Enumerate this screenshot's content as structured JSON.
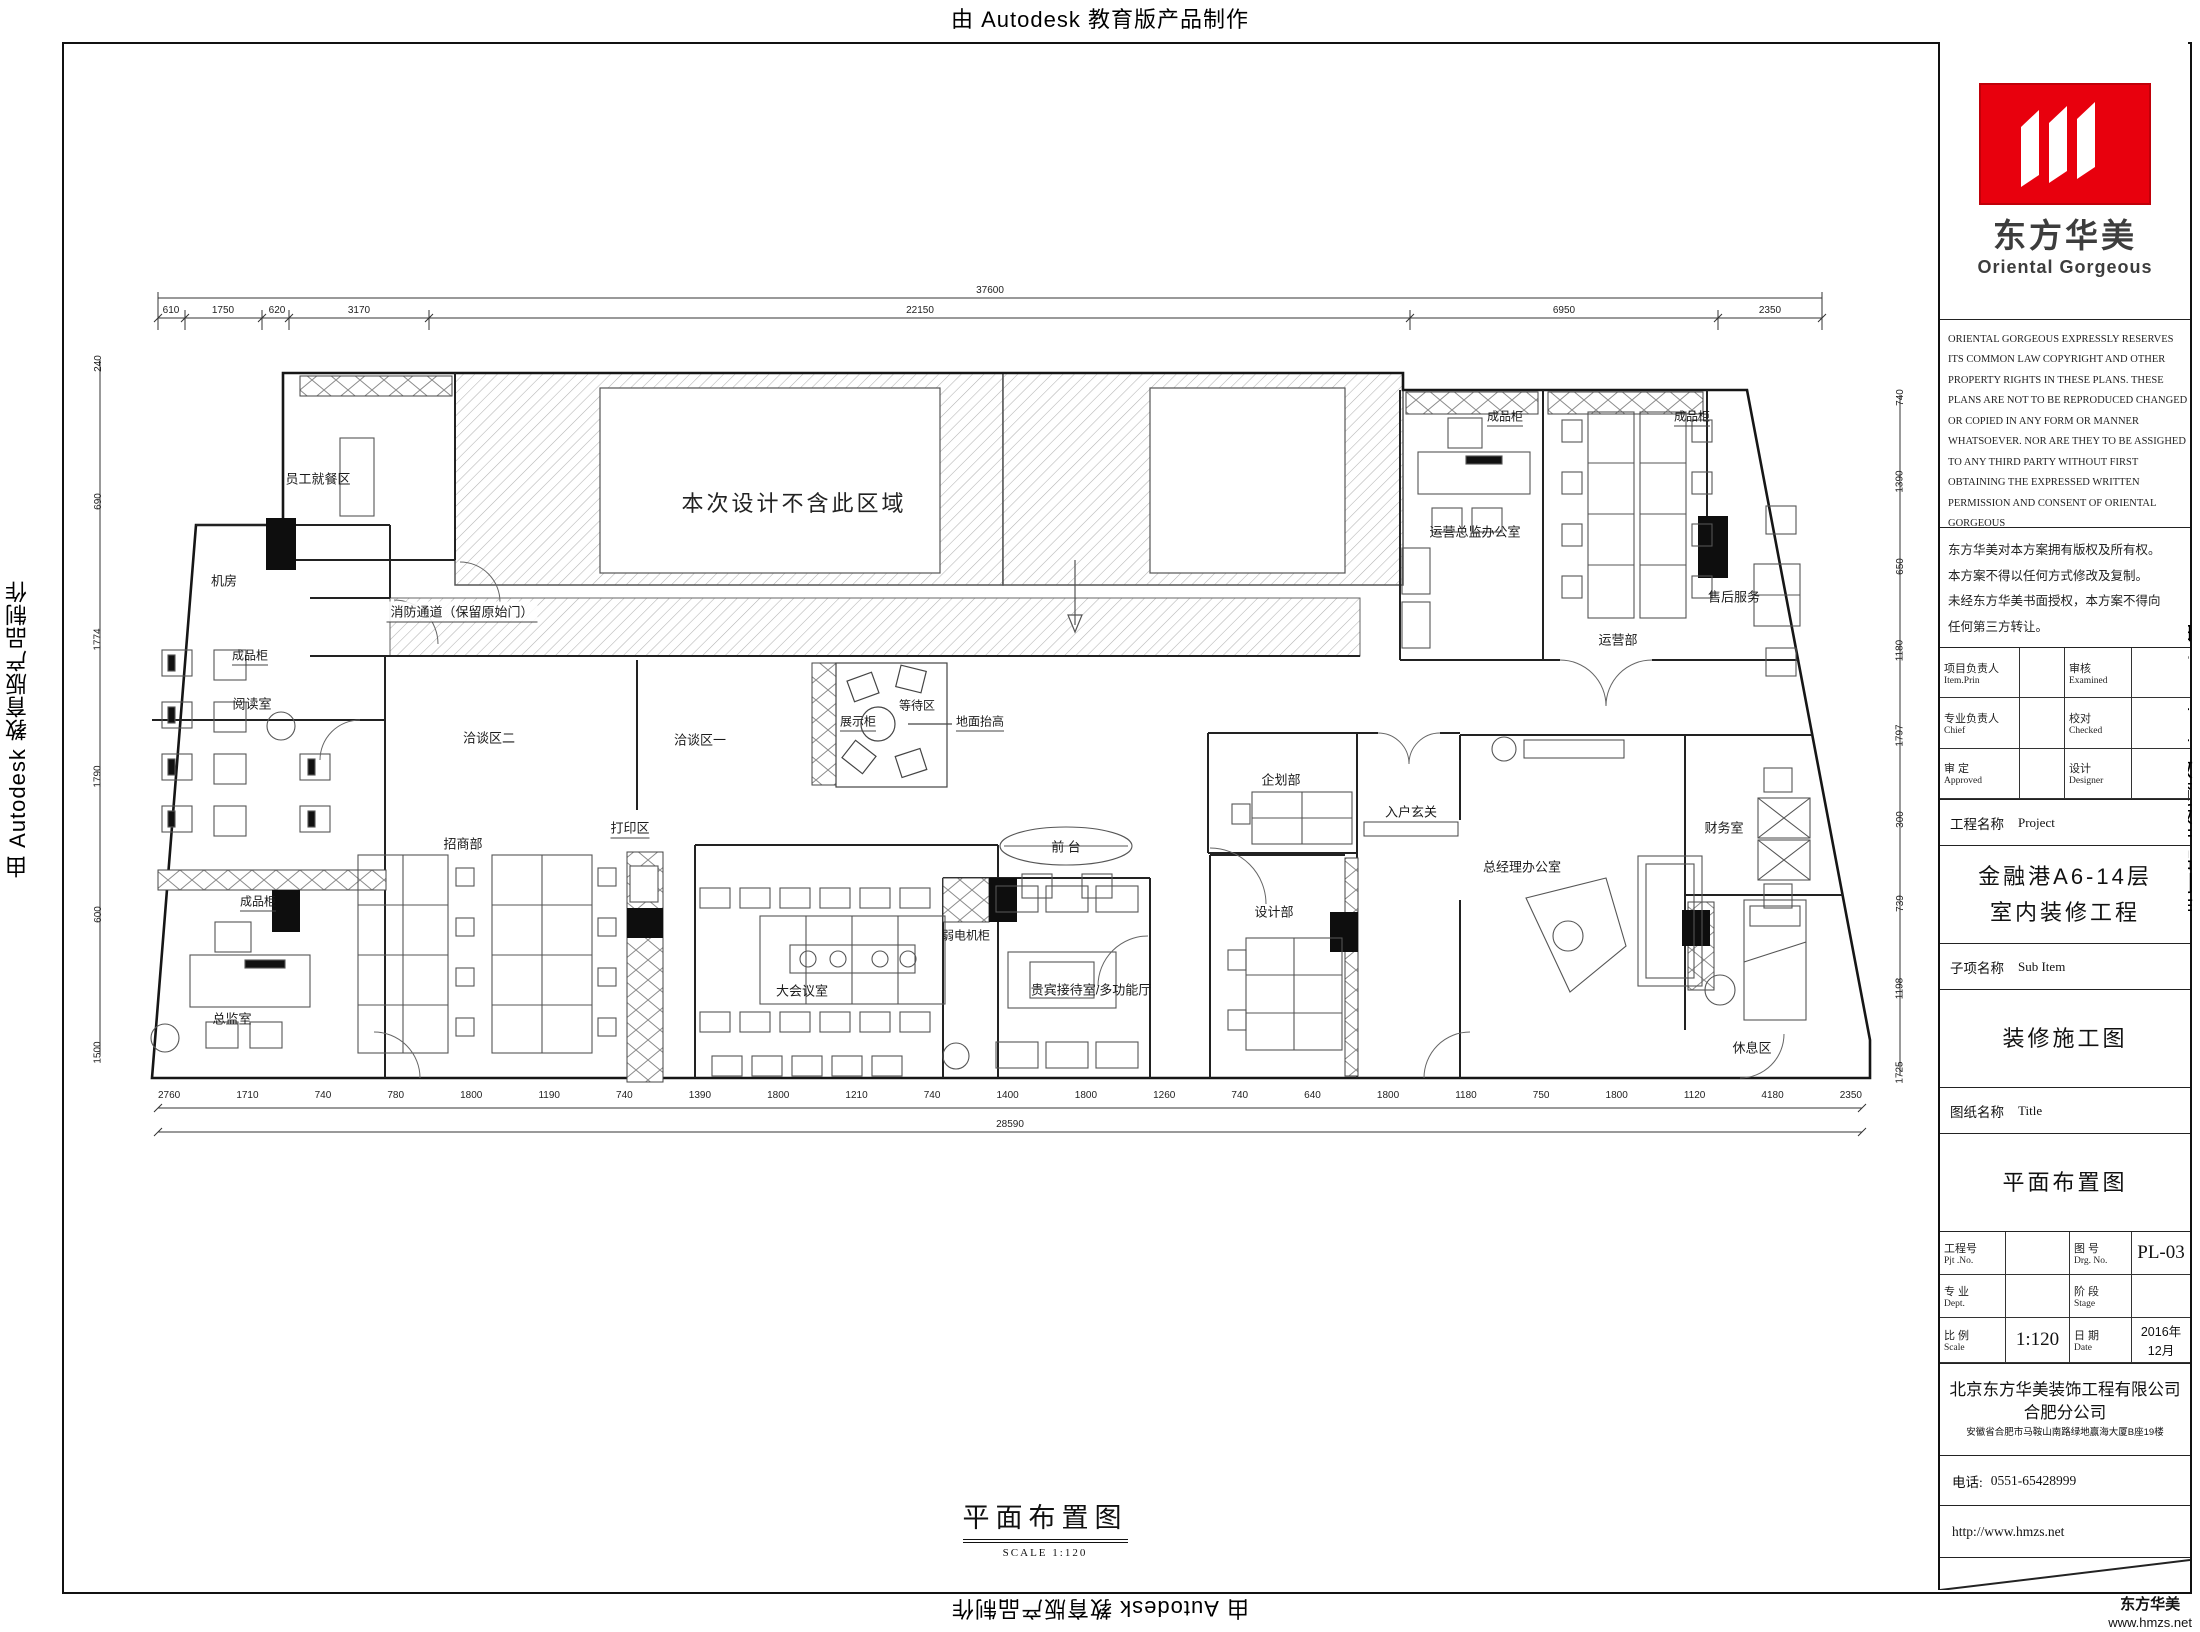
{
  "watermark": {
    "text": "由 Autodesk 教育版产品制作"
  },
  "corner": {
    "brand": "东方华美",
    "url": "www.hmzs.net"
  },
  "brand": {
    "name_cn": "东方华美",
    "name_en": "Oriental  Gorgeous",
    "logo_color": "#e8000d"
  },
  "title_block": {
    "copyright_en": [
      "ORIENTAL GORGEOUS EXPRESSLY RESERVES",
      "ITS COMMON LAW COPYRIGHT AND OTHER",
      "PROPERTY RIGHTS IN THESE PLANS. THESE",
      "PLANS ARE NOT TO BE REPRODUCED CHANGED",
      "OR COPIED IN ANY FORM OR MANNER",
      "WHATSOEVER. NOR ARE THEY TO BE ASSIGHED",
      "TO ANY THIRD PARTY WITHOUT FIRST",
      "OBTAINING THE EXPRESSED WRITTEN",
      "PERMISSION AND CONSENT OF ORIENTAL",
      "GORGEOUS"
    ],
    "copyright_cn": [
      "东方华美对本方案拥有版权及所有权。",
      "本方案不得以任何方式修改及复制。",
      "未经东方华美书面授权，本方案不得向",
      "任何第三方转让。"
    ],
    "personnel": {
      "rows": [
        {
          "c1": "项目负责人",
          "e1": "Item.Prin",
          "c2": "审核",
          "e2": "Examined"
        },
        {
          "c1": "专业负责人",
          "e1": "Chief",
          "c2": "校对",
          "e2": "Checked"
        },
        {
          "c1": "审 定",
          "e1": "Approved",
          "c2": "设计",
          "e2": "Designer"
        }
      ]
    },
    "project_label_cn": "工程名称",
    "project_label_en": "Project",
    "project_name_line1": "金融港A6-14层",
    "project_name_line2": "室内装修工程",
    "subitem_label_cn": "子项名称",
    "subitem_label_en": "Sub Item",
    "subitem_value": "装修施工图",
    "sheet_label_cn": "图纸名称",
    "sheet_label_en": "Title",
    "sheet_value": "平面布置图",
    "meta": {
      "pjt_cn": "工程号",
      "pjt_en": "Pjt .No.",
      "drg_cn": "图 号",
      "drg_en": "Drg. No.",
      "drg_no": "PL-03",
      "dept_cn": "专 业",
      "dept_en": "Dept.",
      "stage_cn": "阶 段",
      "stage_en": "Stage",
      "scale_cn": "比 例",
      "scale_en": "Scale",
      "scale_value": "1:120",
      "date_cn": "日 期",
      "date_en": "Date",
      "date_value": "2016年12月"
    },
    "company": {
      "name": "北京东方华美装饰工程有限公司",
      "branch": "合肥分公司",
      "address": "安徽省合肥市马鞍山南路绿地赢海大厦B座19楼",
      "phone_label": "电话:",
      "phone": "0551-65428999",
      "website": "http://www.hmzs.net"
    }
  },
  "plan": {
    "labels": {
      "staff_dining": "员工就餐区",
      "machine_room": "机房",
      "cabinet": "成品柜",
      "reading_room": "阅读室",
      "director_office": "总监室",
      "merchants_dept": "招商部",
      "print_area": "打印区",
      "big_meeting_room": "大会议室",
      "talk_area_2": "洽谈区二",
      "talk_area_1": "洽谈区一",
      "display_cabinet": "展示柜",
      "waiting_area": "等待区",
      "floor_raised": "地面抬高",
      "reception": "前 台",
      "weak_current": "弱电机柜",
      "vip_room": "贵宾接待室/多功能厅",
      "planning_dept": "企划部",
      "design_dept": "设计部",
      "entry_hall": "入户玄关",
      "gm_office": "总经理办公室",
      "ops_director_office": "运营总监办公室",
      "ops_dept": "运营部",
      "after_sales": "售后服务",
      "finance_room": "财务室",
      "rest_area": "休息区",
      "excluded_note": "本次设计不含此区域",
      "fire_corridor": "消防通道（保留原始门）"
    }
  },
  "dims": {
    "top_total": "37600",
    "top_segments": [
      "610",
      "1750",
      "620",
      "3170",
      "22150",
      "6950",
      "2350"
    ],
    "bottom_total": "28590",
    "bottom_segments": [
      "2760",
      "1710",
      "740",
      "780",
      "1800",
      "1190",
      "740",
      "1390",
      "1800",
      "1210",
      "740",
      "1400",
      "1800",
      "1260",
      "740",
      "640",
      "1800",
      "1180",
      "750",
      "1800",
      "1120",
      "4180",
      "2350"
    ],
    "left_segments": [
      "240",
      "690",
      "1774",
      "1790",
      "600",
      "1500"
    ],
    "right_segments": [
      "740",
      "1390",
      "650",
      "1180",
      "1797",
      "300",
      "739",
      "1198",
      "1725"
    ]
  },
  "footer": {
    "drawing_title": "平面布置图",
    "scale_note": "SCALE  1:120"
  }
}
